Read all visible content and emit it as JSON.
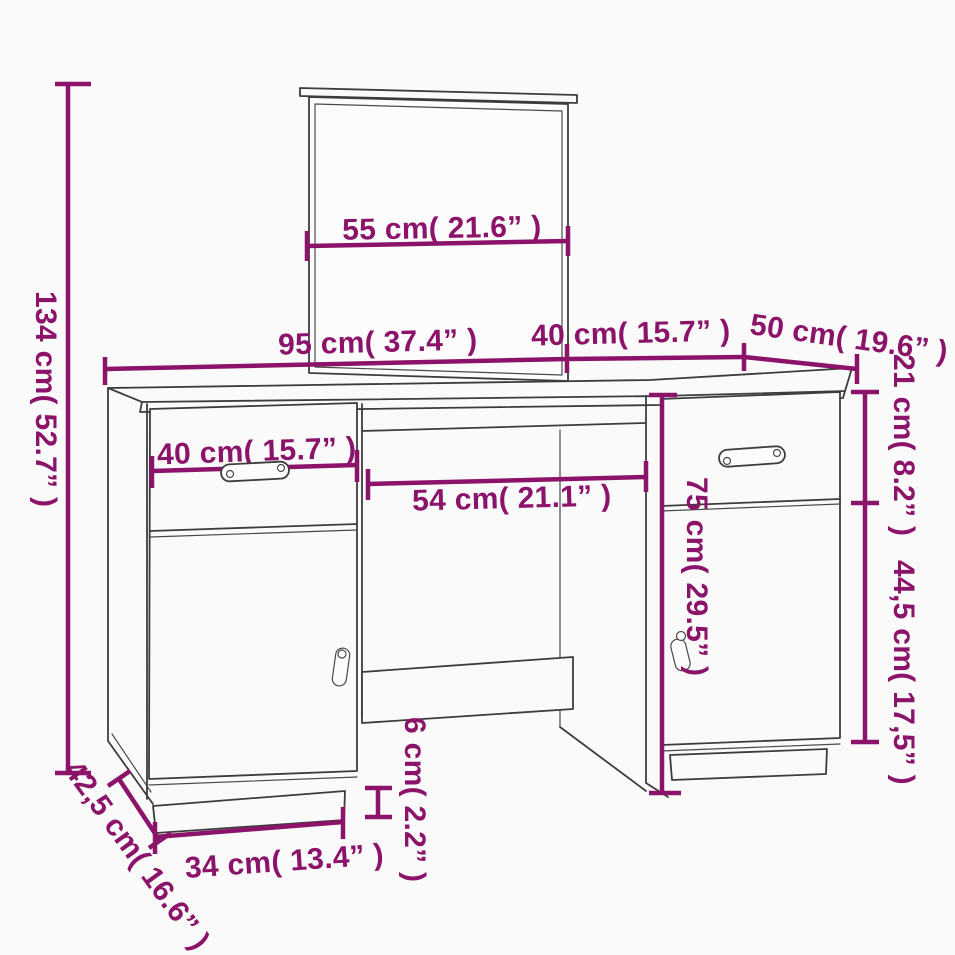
{
  "image": {
    "description": "Technical dimension diagram of a dressing table set with mirror, two pedestal cabinets (each with drawer and door) and open knee space",
    "style": "3d line drawing with purple dimension annotations"
  },
  "colors": {
    "dimension_accent": "#8B1369",
    "drawing_line": "#3d3d3d",
    "background": "#fafafa"
  },
  "dimensions": {
    "total_height": "134 cm( 52.7” )",
    "mirror_width": "55 cm( 21.6” )",
    "desk_width": "95 cm( 37.4” )",
    "right_cabinet_top_width": "40 cm( 15.7” )",
    "right_cabinet_depth": "50 cm( 19.6” )",
    "right_drawer_height": "21 cm( 8.2” )",
    "right_door_height": "44,5 cm( 17,5” )",
    "left_drawer_width": "40 cm( 15.7” )",
    "knee_space_width": "54 cm( 21.1” )",
    "cabinet_body_height": "75 cm( 29.5” )",
    "plinth_height": "6 cm( 2.2” )",
    "plinth_width": "34 cm( 13.4” )",
    "left_cabinet_depth": "42,5 cm( 16.6” )"
  }
}
